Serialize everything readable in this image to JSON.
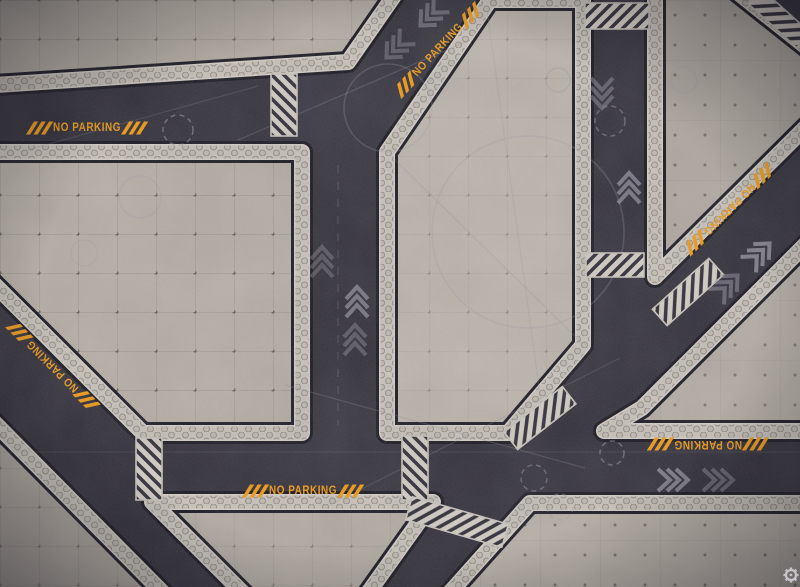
{
  "scene": {
    "description": "top-down sci-fi industrial battle mat: dark asphalt roads between concrete platforms",
    "width": 800,
    "height": 587
  },
  "palette": {
    "road": "#302e38",
    "road_dark_gap": "#17161f",
    "band_bg": "#2c2a34",
    "stripe": "#d2cdc5",
    "border_bright": "#d4cfc7",
    "hex_strip": "#c8c2ba",
    "orange": "#ef9a14",
    "chevron": "#908e9a",
    "guide": "#9d9ba8"
  },
  "road_labels": [
    {
      "text": "NO PARKING",
      "x": 87,
      "y": 128,
      "rot": 0
    },
    {
      "text": "NO PARKING",
      "x": 438,
      "y": 50,
      "rot": -47
    },
    {
      "text": "NO PARKING",
      "x": 53,
      "y": 366,
      "rot": -135
    },
    {
      "text": "NO PARKING",
      "x": 729,
      "y": 209,
      "rot": 135
    },
    {
      "text": "NO PARKING",
      "x": 708,
      "y": 444,
      "rot": 180
    },
    {
      "text": "NO PARKING",
      "x": 303,
      "y": 491,
      "rot": 0
    }
  ],
  "platforms": [
    {
      "name": "platform-top-left",
      "shade": "#b3aca3",
      "pattern": "gridA",
      "pat_op": 0.9,
      "points": [
        [
          -20,
          -20
        ],
        [
          405,
          -20
        ],
        [
          348,
          62
        ],
        [
          -20,
          86
        ]
      ]
    },
    {
      "name": "platform-left-field",
      "shade": "#b5aea5",
      "pattern": "gridA",
      "pat_op": 1,
      "points": [
        [
          -20,
          152
        ],
        [
          302,
          152
        ],
        [
          302,
          433
        ],
        [
          143,
          433
        ],
        [
          -20,
          270
        ]
      ]
    },
    {
      "name": "platform-central",
      "shade": "#bcb5ac",
      "pattern": "gridA",
      "pat_op": 0.45,
      "points": [
        [
          387,
          152
        ],
        [
          490,
          0
        ],
        [
          583,
          0
        ],
        [
          583,
          345
        ],
        [
          508,
          433
        ],
        [
          387,
          433
        ]
      ]
    },
    {
      "name": "platform-top-right",
      "shade": "#b0a9a1",
      "pattern": "dotsB",
      "pat_op": 1,
      "points": [
        [
          655,
          -20
        ],
        [
          722,
          -20
        ],
        [
          820,
          58
        ],
        [
          820,
          113
        ],
        [
          655,
          277
        ]
      ]
    },
    {
      "name": "platform-right-wedge",
      "shade": "#b4ada4",
      "pattern": "dotsB",
      "pat_op": 0.9,
      "points": [
        [
          604,
          431
        ],
        [
          642,
          408
        ],
        [
          820,
          230
        ],
        [
          820,
          431
        ]
      ]
    },
    {
      "name": "platform-bottom-left",
      "shade": "#aea79f",
      "pattern": "gridA",
      "pat_op": 0.7,
      "points": [
        [
          -20,
          408
        ],
        [
          177,
          607
        ],
        [
          -20,
          607
        ]
      ]
    },
    {
      "name": "platform-bottom-center",
      "shade": "#b2aba2",
      "pattern": "gridA",
      "pat_op": 0.6,
      "points": [
        [
          152,
          502
        ],
        [
          433,
          502
        ],
        [
          358,
          607
        ],
        [
          257,
          607
        ]
      ]
    },
    {
      "name": "platform-bottom-right",
      "shade": "#b7b0a7",
      "pattern": "dotsB",
      "pat_op": 1,
      "points": [
        [
          530,
          503
        ],
        [
          820,
          503
        ],
        [
          820,
          607
        ],
        [
          437,
          607
        ]
      ]
    }
  ],
  "hazard_crossings": [
    {
      "cx": 284,
      "cy": 105,
      "len": 62,
      "w": 26,
      "angle": 90
    },
    {
      "cx": 617,
      "cy": 16,
      "len": 64,
      "w": 26,
      "angle": 0
    },
    {
      "cx": 615,
      "cy": 265,
      "len": 58,
      "w": 24,
      "angle": 0
    },
    {
      "cx": 688,
      "cy": 292,
      "len": 76,
      "w": 22,
      "angle": -42
    },
    {
      "cx": 540,
      "cy": 418,
      "len": 74,
      "w": 22,
      "angle": -38
    },
    {
      "cx": 415,
      "cy": 468,
      "len": 64,
      "w": 26,
      "angle": 90
    },
    {
      "cx": 149,
      "cy": 469,
      "len": 62,
      "w": 26,
      "angle": 90
    },
    {
      "cx": 457,
      "cy": 522,
      "len": 100,
      "w": 24,
      "angle": 16
    },
    {
      "cx": 779,
      "cy": 18,
      "len": 66,
      "w": 20,
      "angle": 42
    }
  ],
  "chevrons": [
    {
      "x": 322,
      "y": 252,
      "rot": 0,
      "o": 0.4
    },
    {
      "x": 357,
      "y": 292,
      "rot": 0,
      "o": 0.75
    },
    {
      "x": 355,
      "y": 330,
      "rot": 0,
      "o": 0.45
    },
    {
      "x": 602,
      "y": 103,
      "rot": 180,
      "o": 0.5
    },
    {
      "x": 629,
      "y": 178,
      "rot": 0,
      "o": 0.75
    },
    {
      "x": 424,
      "y": 22,
      "rot": -135,
      "o": 0.55
    },
    {
      "x": 390,
      "y": 54,
      "rot": -135,
      "o": 0.45
    },
    {
      "x": 766,
      "y": 247,
      "rot": 45,
      "o": 0.85
    },
    {
      "x": 734,
      "y": 279,
      "rot": 45,
      "o": 0.55
    },
    {
      "x": 683,
      "y": 480,
      "rot": 90,
      "o": 0.8
    },
    {
      "x": 728,
      "y": 480,
      "rot": 90,
      "o": 0.5
    }
  ],
  "guide_circles": [
    {
      "cx": 178,
      "cy": 130,
      "r": 15,
      "dash": 1,
      "o": 0.5
    },
    {
      "cx": 610,
      "cy": 121,
      "r": 15,
      "dash": 1,
      "o": 0.45
    },
    {
      "cx": 612,
      "cy": 453,
      "r": 12,
      "dash": 1,
      "o": 0.5
    },
    {
      "cx": 534,
      "cy": 478,
      "r": 13,
      "dash": 1,
      "o": 0.45
    },
    {
      "cx": 560,
      "cy": 507,
      "r": 13,
      "dash": 1,
      "o": 0.4
    },
    {
      "cx": 140,
      "cy": 197,
      "r": 21,
      "dash": 0,
      "o": 0.28
    },
    {
      "cx": 84,
      "cy": 253,
      "r": 13,
      "dash": 0,
      "o": 0.22
    },
    {
      "cx": 558,
      "cy": 80,
      "r": 12,
      "dash": 0,
      "o": 0.35
    },
    {
      "cx": 684,
      "cy": 80,
      "r": 13,
      "dash": 0,
      "o": 0.3
    },
    {
      "cx": 528,
      "cy": 232,
      "r": 96,
      "dash": 0,
      "o": 0.28
    },
    {
      "cx": 388,
      "cy": 108,
      "r": 44,
      "dash": 0,
      "o": 0.26
    }
  ],
  "guide_lines": [
    {
      "x1": 238,
      "y1": 140,
      "x2": 470,
      "y2": 40,
      "o": 0.3,
      "dash": 0
    },
    {
      "x1": 20,
      "y1": 152,
      "x2": 258,
      "y2": 86,
      "o": 0.22,
      "dash": 0
    },
    {
      "x1": 285,
      "y1": 385,
      "x2": 585,
      "y2": 468,
      "o": 0.28,
      "dash": 0
    },
    {
      "x1": 330,
      "y1": 505,
      "x2": 620,
      "y2": 358,
      "o": 0.24,
      "dash": 0
    },
    {
      "x1": 0,
      "y1": 452,
      "x2": 800,
      "y2": 452,
      "o": 0.16,
      "dash": 0
    },
    {
      "x1": 395,
      "y1": 160,
      "x2": 583,
      "y2": 344,
      "o": 0.22,
      "dash": 0
    },
    {
      "x1": 487,
      "y1": 10,
      "x2": 545,
      "y2": 430,
      "o": 0.18,
      "dash": 0
    },
    {
      "x1": 338,
      "y1": 165,
      "x2": 338,
      "y2": 425,
      "o": 0.28,
      "dash": 1
    }
  ],
  "wear_patches": [
    {
      "cx": 350,
      "cy": 110,
      "r": 95,
      "kind": "light",
      "o": 0.16
    },
    {
      "cx": 335,
      "cy": 470,
      "r": 115,
      "kind": "light",
      "o": 0.14
    },
    {
      "cx": 610,
      "cy": 300,
      "r": 85,
      "kind": "light",
      "o": 0.12
    },
    {
      "cx": 470,
      "cy": 30,
      "r": 70,
      "kind": "light",
      "o": 0.1
    },
    {
      "cx": 60,
      "cy": 120,
      "r": 80,
      "kind": "dark",
      "o": 0.22
    },
    {
      "cx": 760,
      "cy": 460,
      "r": 90,
      "kind": "dark",
      "o": 0.16
    },
    {
      "cx": 100,
      "cy": 480,
      "r": 90,
      "kind": "dark",
      "o": 0.18
    }
  ],
  "logo": {
    "icon": "gear",
    "x": 791,
    "y": 575
  }
}
